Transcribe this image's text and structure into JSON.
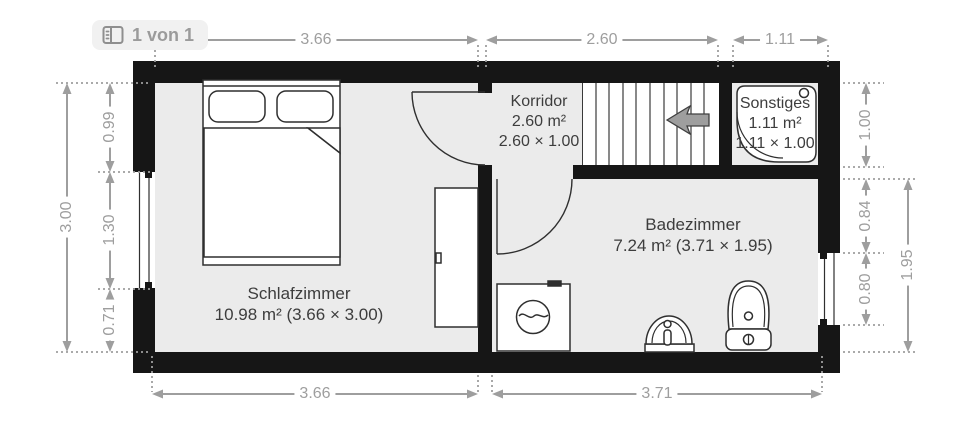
{
  "badge": {
    "label": "1 von 1"
  },
  "rooms": {
    "schlafzimmer": {
      "name": "Schlafzimmer",
      "line2": "10.98 m² (3.66 × 3.00)"
    },
    "korridor": {
      "name": "Korridor",
      "line2": "2.60 m²",
      "line3": "2.60 × 1.00"
    },
    "sonstiges": {
      "name": "Sonstiges",
      "line2": "1.11 m²",
      "line3": "1.11 × 1.00"
    },
    "badezimmer": {
      "name": "Badezimmer",
      "line2": "7.24 m² (3.71 × 1.95)"
    }
  },
  "dimensions": {
    "top": {
      "d1": "3.66",
      "d2": "2.60",
      "d3": "1.11"
    },
    "bottom": {
      "d1": "3.66",
      "d2": "3.71"
    },
    "left": {
      "outer": "3.00",
      "inner1": "0.99",
      "inner2": "1.30",
      "inner3": "0.71"
    },
    "right": {
      "inner1": "1.00",
      "inner2": "0.84",
      "inner3": "0.80",
      "outer": "1.95"
    }
  },
  "icons": {
    "badge_icon": "floorplan-page-icon",
    "stairs_arrow": "stairs-direction-arrow-left"
  },
  "colors": {
    "wall": "#161616",
    "floor": "#ebebeb",
    "dimension": "#9e9e9e",
    "room_label": "#3d3d3d",
    "outline": "#2f2f2f",
    "badge_bg": "#f1f1f1",
    "badge_text": "#9b9b9b",
    "arrow_fill": "#9e9e9e"
  }
}
